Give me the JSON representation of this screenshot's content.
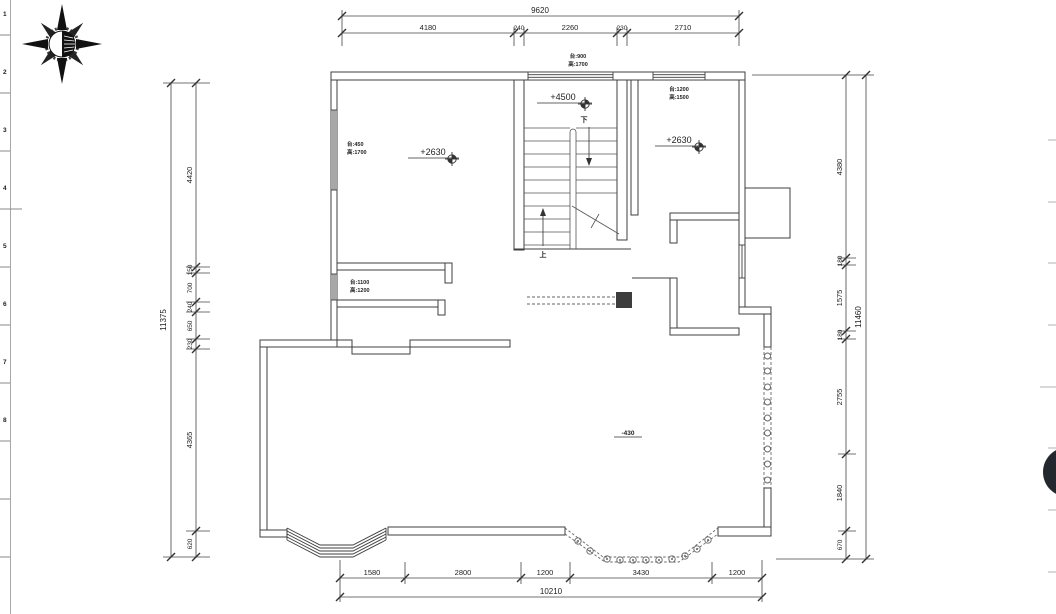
{
  "app": {
    "title": "floor-plan-drawing",
    "fab_color": "#23272e",
    "line_color": "#3f3f3f",
    "column_fill": "#3d3d3d"
  },
  "ruler": {
    "marks": [
      "1",
      "2",
      "3",
      "4",
      "5",
      "6",
      "7",
      "8"
    ]
  },
  "dims": {
    "top": {
      "total": "9620",
      "segments": [
        "4180",
        "240",
        "2260",
        "230",
        "2710"
      ]
    },
    "left": {
      "total": "11375",
      "segments": [
        "4420",
        "150",
        "700",
        "240",
        "650",
        "230",
        "4365",
        "620"
      ]
    },
    "right": {
      "total": "11460",
      "segments": [
        "4380",
        "180",
        "1575",
        "180",
        "2755",
        "1840",
        "670"
      ]
    },
    "bottom": {
      "total": "10210",
      "segments": [
        "1580",
        "2800",
        "1200",
        "3430",
        "1200"
      ]
    }
  },
  "levels": {
    "stair_landing": "+4500",
    "left_room": "+2630",
    "right_room": "+2630",
    "terrace": "-430"
  },
  "windows": {
    "top_center": {
      "line1": "台:900",
      "line2": "高:1700"
    },
    "top_right": {
      "line1": "台:1200",
      "line2": "高:1500"
    },
    "left_upper": {
      "line1": "台:450",
      "line2": "高:1700"
    },
    "left_lower": {
      "line1": "台:1100",
      "line2": "高:1200"
    }
  },
  "stair": {
    "up_label": "上",
    "down_label": "下"
  }
}
